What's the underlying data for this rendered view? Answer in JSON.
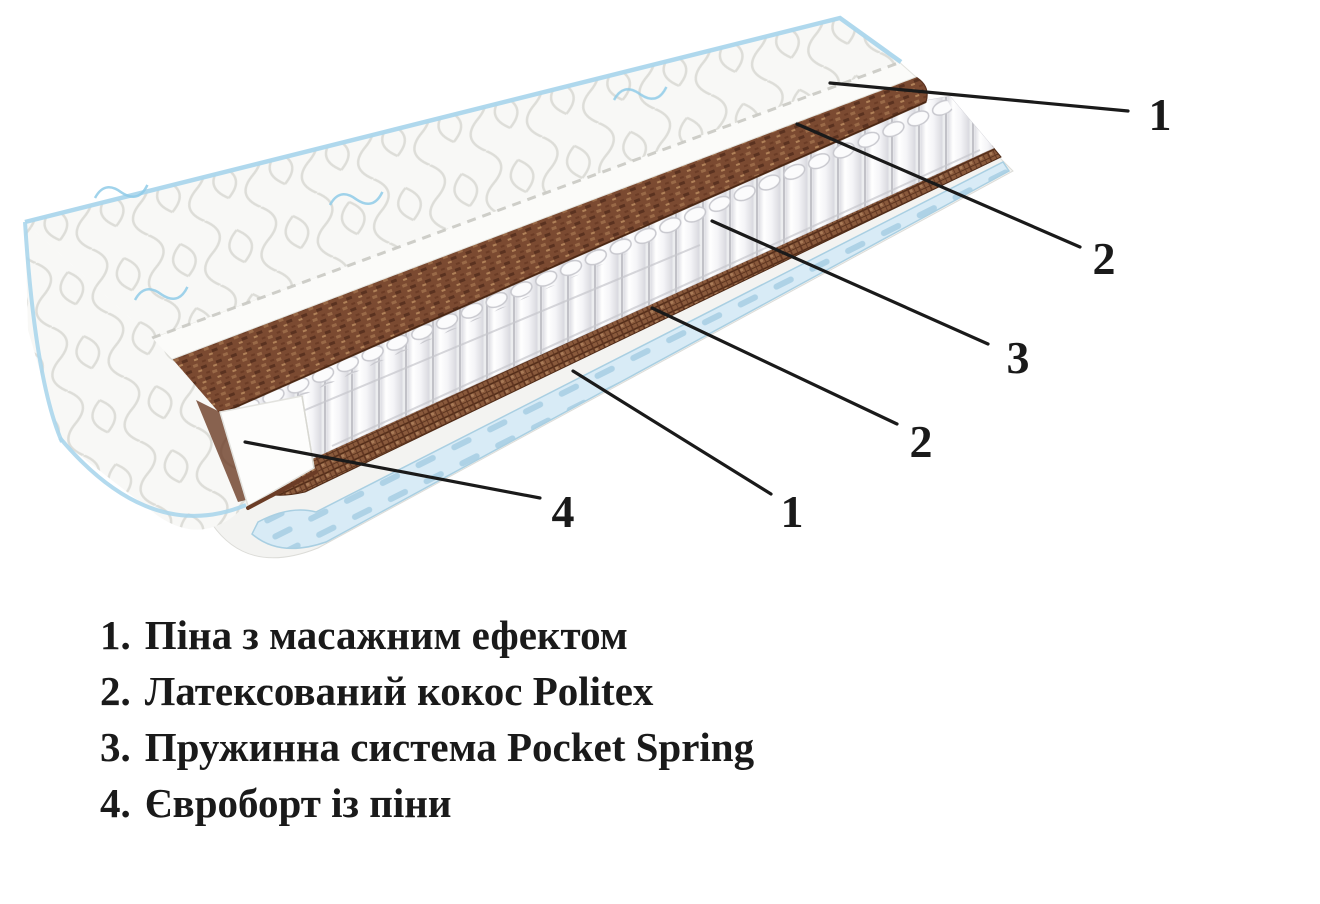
{
  "page": {
    "width": 1320,
    "height": 904,
    "background": "#ffffff"
  },
  "diagram": {
    "type": "mattress-cutaway-layers",
    "description": "Cutaway illustration of a mattress showing quilted cover, foam, coconut, pocket springs, euro border and base",
    "callouts": [
      {
        "id": "foam-top",
        "number": "1"
      },
      {
        "id": "coconut-top",
        "number": "2"
      },
      {
        "id": "spring-system",
        "number": "3"
      },
      {
        "id": "coconut-bottom",
        "number": "2"
      },
      {
        "id": "foam-bottom",
        "number": "1"
      },
      {
        "id": "euro-border",
        "number": "4"
      }
    ]
  },
  "legend": {
    "items": [
      {
        "number": "1.",
        "label": "Піна з масажним ефектом"
      },
      {
        "number": "2.",
        "label": "Латексований кокос Politex"
      },
      {
        "number": "3.",
        "label": "Пружинна система Pocket Spring"
      },
      {
        "number": "4.",
        "label": "Євроборт із піни"
      }
    ]
  },
  "colors": {
    "page_bg": "#ffffff",
    "line_black": "#1a1a1a",
    "coconut": "#7b4a31",
    "coconut_dark": "#5a3220",
    "coconut_edge": "#46230f",
    "grid_brown": "#8a5a3c",
    "spring_white": "#f6f6f8",
    "spring_line": "#c2c2c8",
    "base_blue": "#d8ebf6",
    "base_blue_dash": "#aed2e6",
    "piping_blue": "#abd6ec",
    "logo_blue": "#8fcbe8",
    "fabric_line": "#ddddd8",
    "tray_white": "#f3f3f1"
  }
}
